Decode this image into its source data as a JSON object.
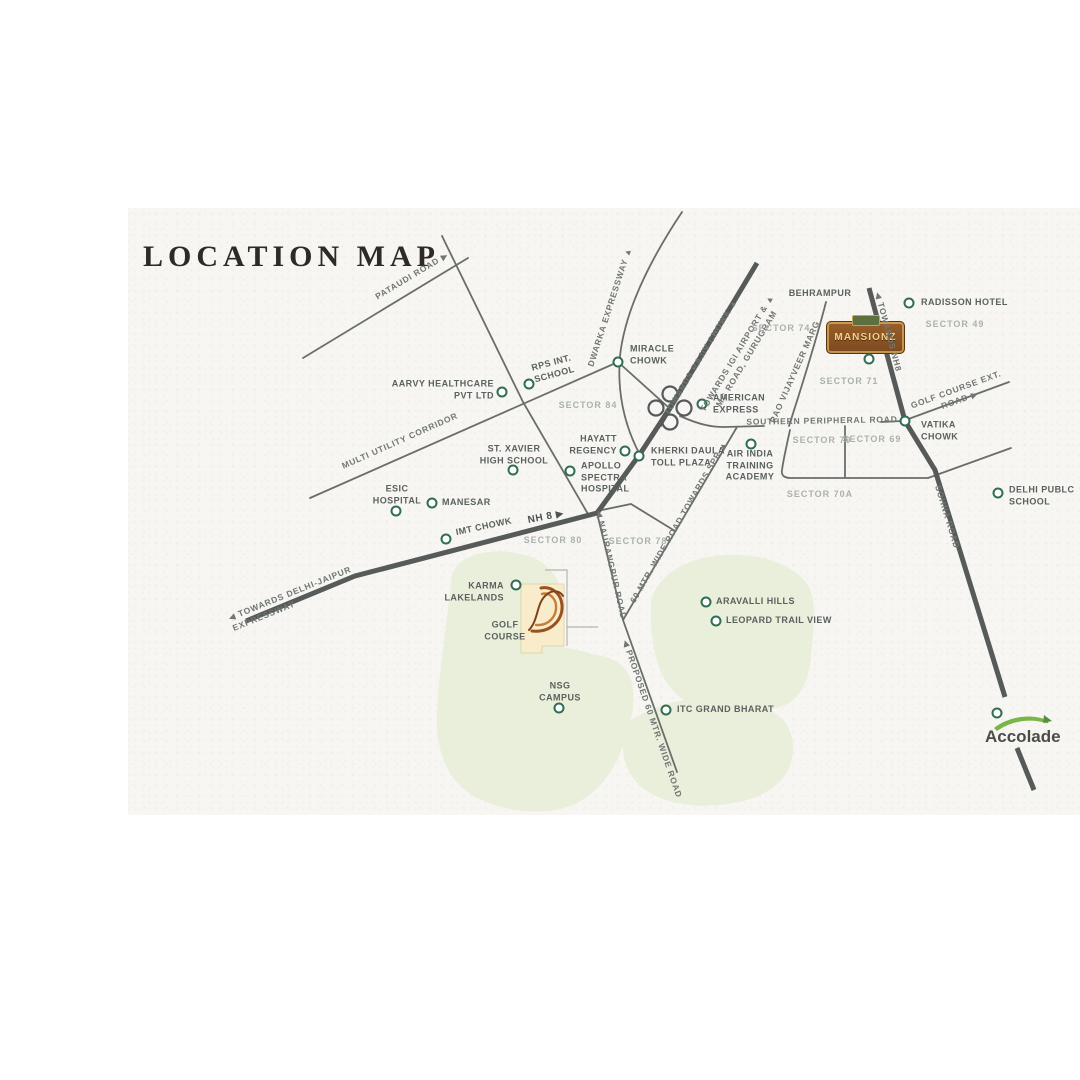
{
  "title": "LOCATION MAP",
  "project": {
    "name": "MANSIONZ",
    "sign_location": "SECTOR 71"
  },
  "developer": {
    "name": "Accolade"
  },
  "colors": {
    "marker_ring": "#2f6e53",
    "road_thin": "#6a6e6b",
    "road_thick": "#565a59",
    "green_area": "#e9efdb",
    "plot_beige": "#f9ecca",
    "label_text": "#5a615e",
    "sector_text": "#abb1ad",
    "sign_brown": "#8a5326",
    "sign_gold": "#f1d28c",
    "accolade_green": "#7ab548"
  },
  "places": [
    {
      "id": "aarvy-healthcare",
      "label": "AARVY HEALTHCARE\nPVT LTD",
      "x": 494,
      "y": 390,
      "anchor": "r",
      "marker": {
        "x": 502,
        "y": 392
      }
    },
    {
      "id": "rps-int-school",
      "label": "RPS INT.\nSCHOOL",
      "x": 553,
      "y": 369,
      "anchor": "c",
      "rot": -15,
      "marker": {
        "x": 529,
        "y": 384
      }
    },
    {
      "id": "miracle-chowk",
      "label": "MIRACLE\nCHOWK",
      "x": 630,
      "y": 355,
      "anchor": "l",
      "marker": {
        "x": 618,
        "y": 362
      }
    },
    {
      "id": "american-express",
      "label": "AMERICAN\nEXPRESS",
      "x": 713,
      "y": 404,
      "anchor": "l",
      "marker": {
        "x": 702,
        "y": 404
      }
    },
    {
      "id": "hayatt-regency",
      "label": "HAYATT\nREGENCY",
      "x": 617,
      "y": 445,
      "anchor": "r",
      "marker": {
        "x": 625,
        "y": 451
      }
    },
    {
      "id": "kherki-daula-toll-plaza",
      "label": "KHERKI DAULA\nTOLL PLAZA",
      "x": 651,
      "y": 457,
      "anchor": "l",
      "marker": {
        "x": 639,
        "y": 456
      }
    },
    {
      "id": "apollo-spectra-hospital",
      "label": "APOLLO\nSPECTRA\nHOSPITAL",
      "x": 581,
      "y": 478,
      "anchor": "l",
      "marker": {
        "x": 570,
        "y": 471
      }
    },
    {
      "id": "st-xavier-high-school",
      "label": "ST. XAVIER\nHIGH SCHOOL",
      "x": 514,
      "y": 455,
      "anchor": "c",
      "marker": {
        "x": 513,
        "y": 470
      }
    },
    {
      "id": "esic-hospital",
      "label": "ESIC\nHOSPITAL",
      "x": 397,
      "y": 495,
      "anchor": "c",
      "marker": {
        "x": 396,
        "y": 511
      }
    },
    {
      "id": "manesar",
      "label": "MANESAR",
      "x": 442,
      "y": 503,
      "anchor": "l",
      "marker": {
        "x": 432,
        "y": 503
      }
    },
    {
      "id": "imt-chowk",
      "label": "IMT CHOWK",
      "x": 456,
      "y": 533,
      "anchor": "l",
      "rot": -12,
      "marker": {
        "x": 446,
        "y": 539
      }
    },
    {
      "id": "karma-lakelands",
      "label": "KARMA\nLAKELANDS",
      "x": 504,
      "y": 592,
      "anchor": "r",
      "marker": {
        "x": 516,
        "y": 585
      }
    },
    {
      "id": "golf-course",
      "label": "GOLF\nCOURSE",
      "x": 505,
      "y": 631,
      "anchor": "c"
    },
    {
      "id": "nsg-campus",
      "label": "NSG\nCAMPUS",
      "x": 560,
      "y": 692,
      "anchor": "c",
      "marker": {
        "x": 559,
        "y": 708
      }
    },
    {
      "id": "itc-grand-bharat",
      "label": "ITC GRAND BHARAT",
      "x": 677,
      "y": 710,
      "anchor": "l",
      "marker": {
        "x": 666,
        "y": 710
      }
    },
    {
      "id": "aravalli-hills",
      "label": "ARAVALLI HILLS",
      "x": 716,
      "y": 602,
      "anchor": "l",
      "marker": {
        "x": 706,
        "y": 602
      }
    },
    {
      "id": "leopard-trail-view",
      "label": "LEOPARD TRAIL VIEW",
      "x": 726,
      "y": 621,
      "anchor": "l",
      "marker": {
        "x": 716,
        "y": 621
      }
    },
    {
      "id": "air-india-training-academy",
      "label": "AIR INDIA\nTRAINING\nACADEMY",
      "x": 750,
      "y": 466,
      "anchor": "c",
      "marker": {
        "x": 751,
        "y": 444
      }
    },
    {
      "id": "radisson-hotel",
      "label": "RADISSON HOTEL",
      "x": 921,
      "y": 303,
      "anchor": "l",
      "marker": {
        "x": 909,
        "y": 303
      }
    },
    {
      "id": "delhi-public-school",
      "label": "DELHI PUBLC\nSCHOOL",
      "x": 1009,
      "y": 496,
      "anchor": "l",
      "marker": {
        "x": 998,
        "y": 493
      }
    },
    {
      "id": "vatika-chowk",
      "label": "VATIKA\nCHOWK",
      "x": 921,
      "y": 431,
      "anchor": "l",
      "marker": {
        "x": 905,
        "y": 421
      }
    },
    {
      "id": "behrampur",
      "label": "BEHRAMPUR",
      "x": 820,
      "y": 294,
      "anchor": "c"
    },
    {
      "id": "mansionz-site",
      "marker": {
        "x": 869,
        "y": 359
      }
    },
    {
      "id": "accolade-site",
      "marker": {
        "x": 997,
        "y": 713
      }
    }
  ],
  "road_labels": [
    {
      "id": "pataudi-road",
      "label": "PATAUDI ROAD ▶",
      "x": 412,
      "y": 276,
      "rot": -31
    },
    {
      "id": "dwarka-expressway",
      "label": "DWARKA EXPRESSWAY ▲",
      "x": 610,
      "y": 307,
      "rot": -72
    },
    {
      "id": "multi-utility-corridor",
      "label": "MULTI UTILITY CORRIDOR",
      "x": 400,
      "y": 441,
      "rot": -24
    },
    {
      "id": "towards-rajiv-chowk",
      "label": "TOWARDS RAJIV CHOWK ▲",
      "x": 701,
      "y": 357,
      "rot": -59
    },
    {
      "id": "towards-igi-airport",
      "label": "TOWARDS IGI AIRPORT & ▲\nMG ROAD, GURUGRAM",
      "x": 742,
      "y": 356,
      "rot": -59
    },
    {
      "id": "towards-nh8",
      "label": "◀ TOWARDS NH8",
      "x": 888,
      "y": 332,
      "rot": 75
    },
    {
      "id": "southern-peripheral-road",
      "label": "SOUTHERN PERIPHERAL ROAD",
      "x": 822,
      "y": 421,
      "rot": -1
    },
    {
      "id": "golf-course-ext-road",
      "label": "GOLF COURSE EXT. ROAD ▶",
      "x": 958,
      "y": 395,
      "rot": -20
    },
    {
      "id": "sohna-road",
      "label": "SOHNA ROAD",
      "x": 947,
      "y": 517,
      "rot": 73
    },
    {
      "id": "rao-vijayveer-marg",
      "label": "RAO VIJAYVEER MARG",
      "x": 795,
      "y": 372,
      "rot": -66
    },
    {
      "id": "nh8",
      "label": "NH 8 ▶",
      "x": 546,
      "y": 517,
      "rot": -11,
      "cls": "dark"
    },
    {
      "id": "towards-delhi-jaipur-expressway",
      "label": "◀ TOWARDS DELHI-JAIPUR\nEXPRESSWAY",
      "x": 292,
      "y": 599,
      "rot": -22,
      "ta": "left"
    },
    {
      "id": "naurangpur-road",
      "label": "◀ NAURANGPUR ROAD",
      "x": 611,
      "y": 565,
      "rot": 77
    },
    {
      "id": "road-towards-spr",
      "label": "60 MTR. WIDE ROAD TOWARDS SPR ▲",
      "x": 679,
      "y": 522,
      "rot": -60
    },
    {
      "id": "proposed-60mtr-road",
      "label": "◀ PROPOSED 60 MTR. WIDE ROAD",
      "x": 652,
      "y": 719,
      "rot": 71
    }
  ],
  "sector_labels": [
    {
      "id": "sector-84",
      "label": "SECTOR 84",
      "x": 588,
      "y": 406
    },
    {
      "id": "sector-74",
      "label": "SECTOR 74",
      "x": 781,
      "y": 329
    },
    {
      "id": "sector-49",
      "label": "SECTOR 49",
      "x": 955,
      "y": 325
    },
    {
      "id": "sector-71",
      "label": "SECTOR 71",
      "x": 849,
      "y": 382
    },
    {
      "id": "sector-70",
      "label": "SECTOR 70",
      "x": 822,
      "y": 441
    },
    {
      "id": "sector-69",
      "label": "SECTOR 69",
      "x": 872,
      "y": 440
    },
    {
      "id": "sector-70a",
      "label": "SECTOR 70A",
      "x": 820,
      "y": 495
    },
    {
      "id": "sector-80",
      "label": "SECTOR 80",
      "x": 553,
      "y": 541
    },
    {
      "id": "sector-78",
      "label": "SECTOR 78",
      "x": 638,
      "y": 542
    }
  ]
}
